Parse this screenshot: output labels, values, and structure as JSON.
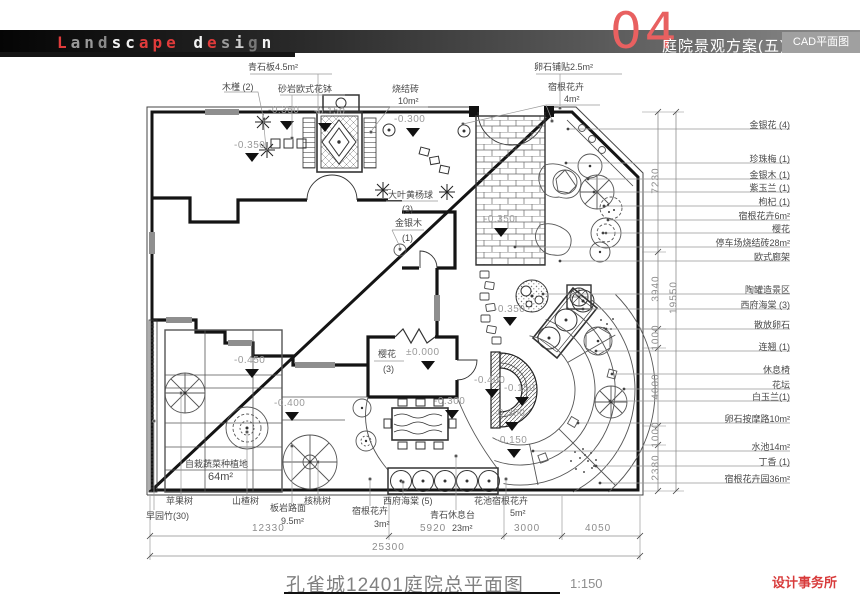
{
  "colors": {
    "accent_red": "#e86060",
    "deep_red": "#d83c3c",
    "wall": "#141414",
    "line_gray": "#8d8d8d"
  },
  "header": {
    "logo_letters": [
      {
        "ch": "L",
        "c": "#e03b3b"
      },
      {
        "ch": "a",
        "c": "#9a9a9a"
      },
      {
        "ch": "n",
        "c": "#9a9a9a"
      },
      {
        "ch": "d",
        "c": "#8a8a8a"
      },
      {
        "ch": "s",
        "c": "#f2f2f2"
      },
      {
        "ch": "c",
        "c": "#f2f2f2"
      },
      {
        "ch": "a",
        "c": "#e03b3b"
      },
      {
        "ch": "p",
        "c": "#e03b3b"
      },
      {
        "ch": "e",
        "c": "#e03b3b"
      },
      {
        "ch": " ",
        "c": "#fff"
      },
      {
        "ch": "d",
        "c": "#f2f2f2"
      },
      {
        "ch": "e",
        "c": "#e03b3b"
      },
      {
        "ch": "s",
        "c": "#9a9a9a"
      },
      {
        "ch": "i",
        "c": "#cfcfcf"
      },
      {
        "ch": "g",
        "c": "#777777"
      },
      {
        "ch": "n",
        "c": "#f2f2f2"
      }
    ],
    "page_number": "04",
    "title": "庭院景观方案(五)",
    "subtitle": "CAD平面图"
  },
  "footer": {
    "title": "孔雀城12401庭院总平面图",
    "scale": "1:150",
    "studio": "设计事务所"
  },
  "plan": {
    "top_labels": {
      "mujin": "木槿 (2)",
      "qingshiban": "青石板4.5m²",
      "shayan": "砂岩欧式花钵",
      "shaojiezhuan": "烧结砖",
      "shaojiezhuan_area": "10m²",
      "luanshiputie": "卵石铺贴2.5m²",
      "sugenhuahui": "宿根花卉",
      "sugenhuahui_area": "4m²"
    },
    "right_labels": [
      "金银花 (4)",
      "珍珠梅 (1)",
      "金银木 (1)",
      "紫玉兰 (1)",
      "枸杞 (1)",
      "宿根花卉6m²",
      "樱花",
      "停车场烧结砖28m²",
      "欧式廊架",
      "陶罐造景区",
      "西府海棠 (3)",
      "散放卵石",
      "连翘 (1)",
      "休息椅",
      "花坛",
      "白玉兰(1)",
      "卵石按摩路10m²",
      "水池14m²",
      "丁香 (1)",
      "宿根花卉园36m²"
    ],
    "bottom_labels": {
      "pingguoshu": "苹果树",
      "zaoyuanzhu": "早园竹(30)",
      "shanzhashu": "山楂树",
      "banyan": "板岩路面",
      "banyan_area": "9.5m²",
      "hetaoshu": "核桃树",
      "xifuhaitang5": "西府海棠 (5)",
      "sugenhuahui": "宿根花卉",
      "sugenhuahui_area": "3m²",
      "qingshixiuxitai": "青石休息台",
      "qingshixiuxitai_area": "23m²",
      "huachi": "花池宿根花卉",
      "huachi_area": "5m²"
    },
    "inner_labels": {
      "vegetable": "自栽蔬菜种植地",
      "vegetable_area": "64m²",
      "dayehuangyang": "大叶黄杨球",
      "dayehuangyang_count": "(3)",
      "jinyinmu": "金银木",
      "jinyinmu_count": "(1)",
      "yinghua": "樱花",
      "yinghua_count": "(3)"
    },
    "elevations": [
      "-0.350",
      "-0.350",
      "-0.150",
      "-0.300",
      "-0.350",
      "-0.350",
      "±0.000",
      "-0.450",
      "-0.400",
      "-0.300",
      "-0.400",
      "-0.150",
      "-0.300",
      "-0.150"
    ],
    "dims": {
      "bottom": [
        "12330",
        "5920",
        "3000",
        "4050"
      ],
      "bottom_total": "25300",
      "right": [
        "7230",
        "3940",
        "1000",
        "4000",
        "1000",
        "2380"
      ],
      "right_total": "19550"
    }
  }
}
